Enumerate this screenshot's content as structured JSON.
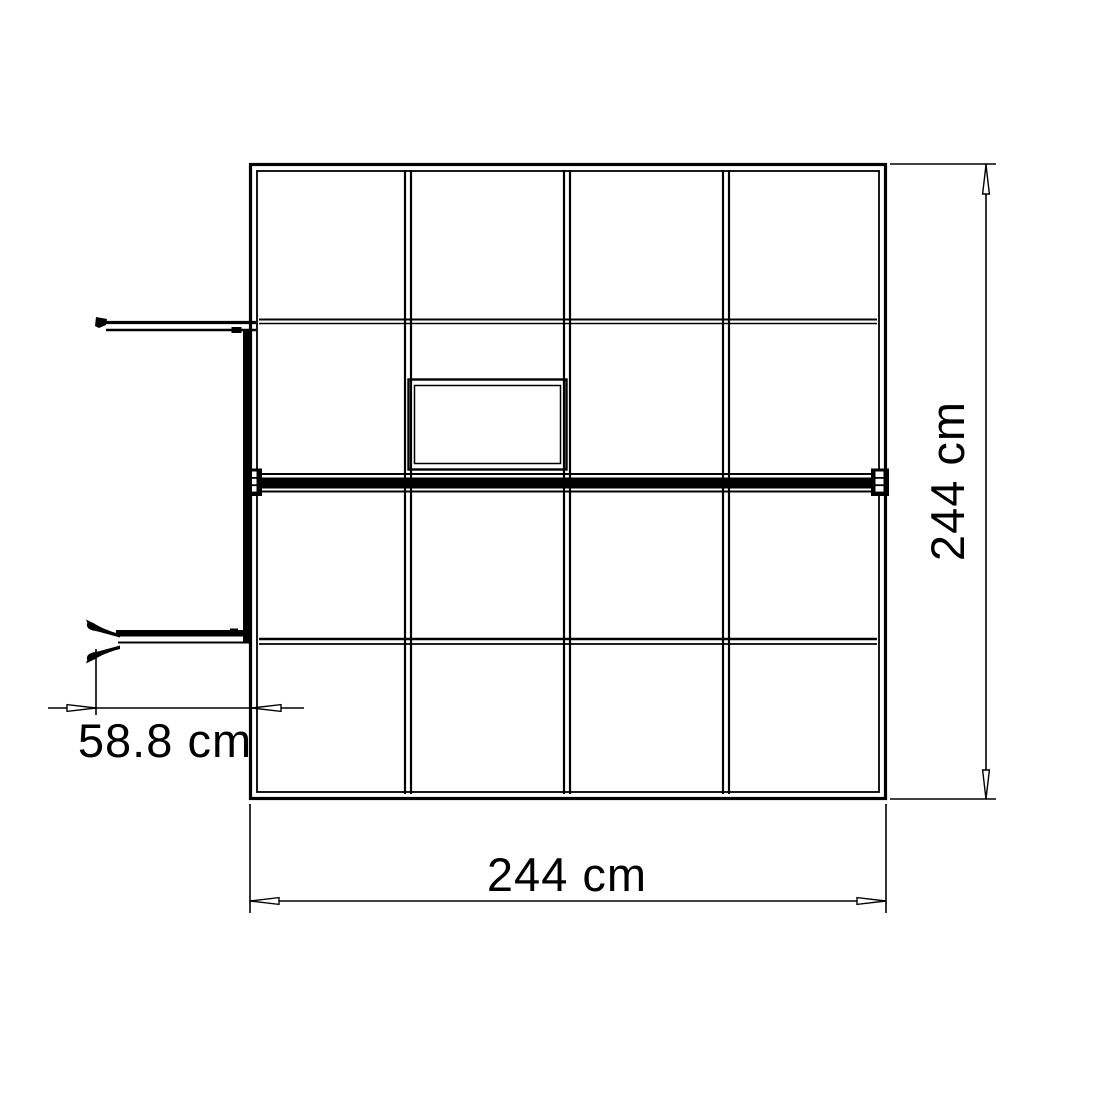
{
  "page": {
    "background_color": "#ffffff",
    "line_color": "#000000"
  },
  "diagram": {
    "kind": "greenhouse-top-view-dimension-drawing",
    "overall_width": {
      "value": 244,
      "unit": "cm",
      "label": "244 cm"
    },
    "overall_depth": {
      "value": 244,
      "unit": "cm",
      "label": "244 cm"
    },
    "door_opening": {
      "value": 58.8,
      "unit": "cm",
      "label": "58.8 cm"
    }
  }
}
